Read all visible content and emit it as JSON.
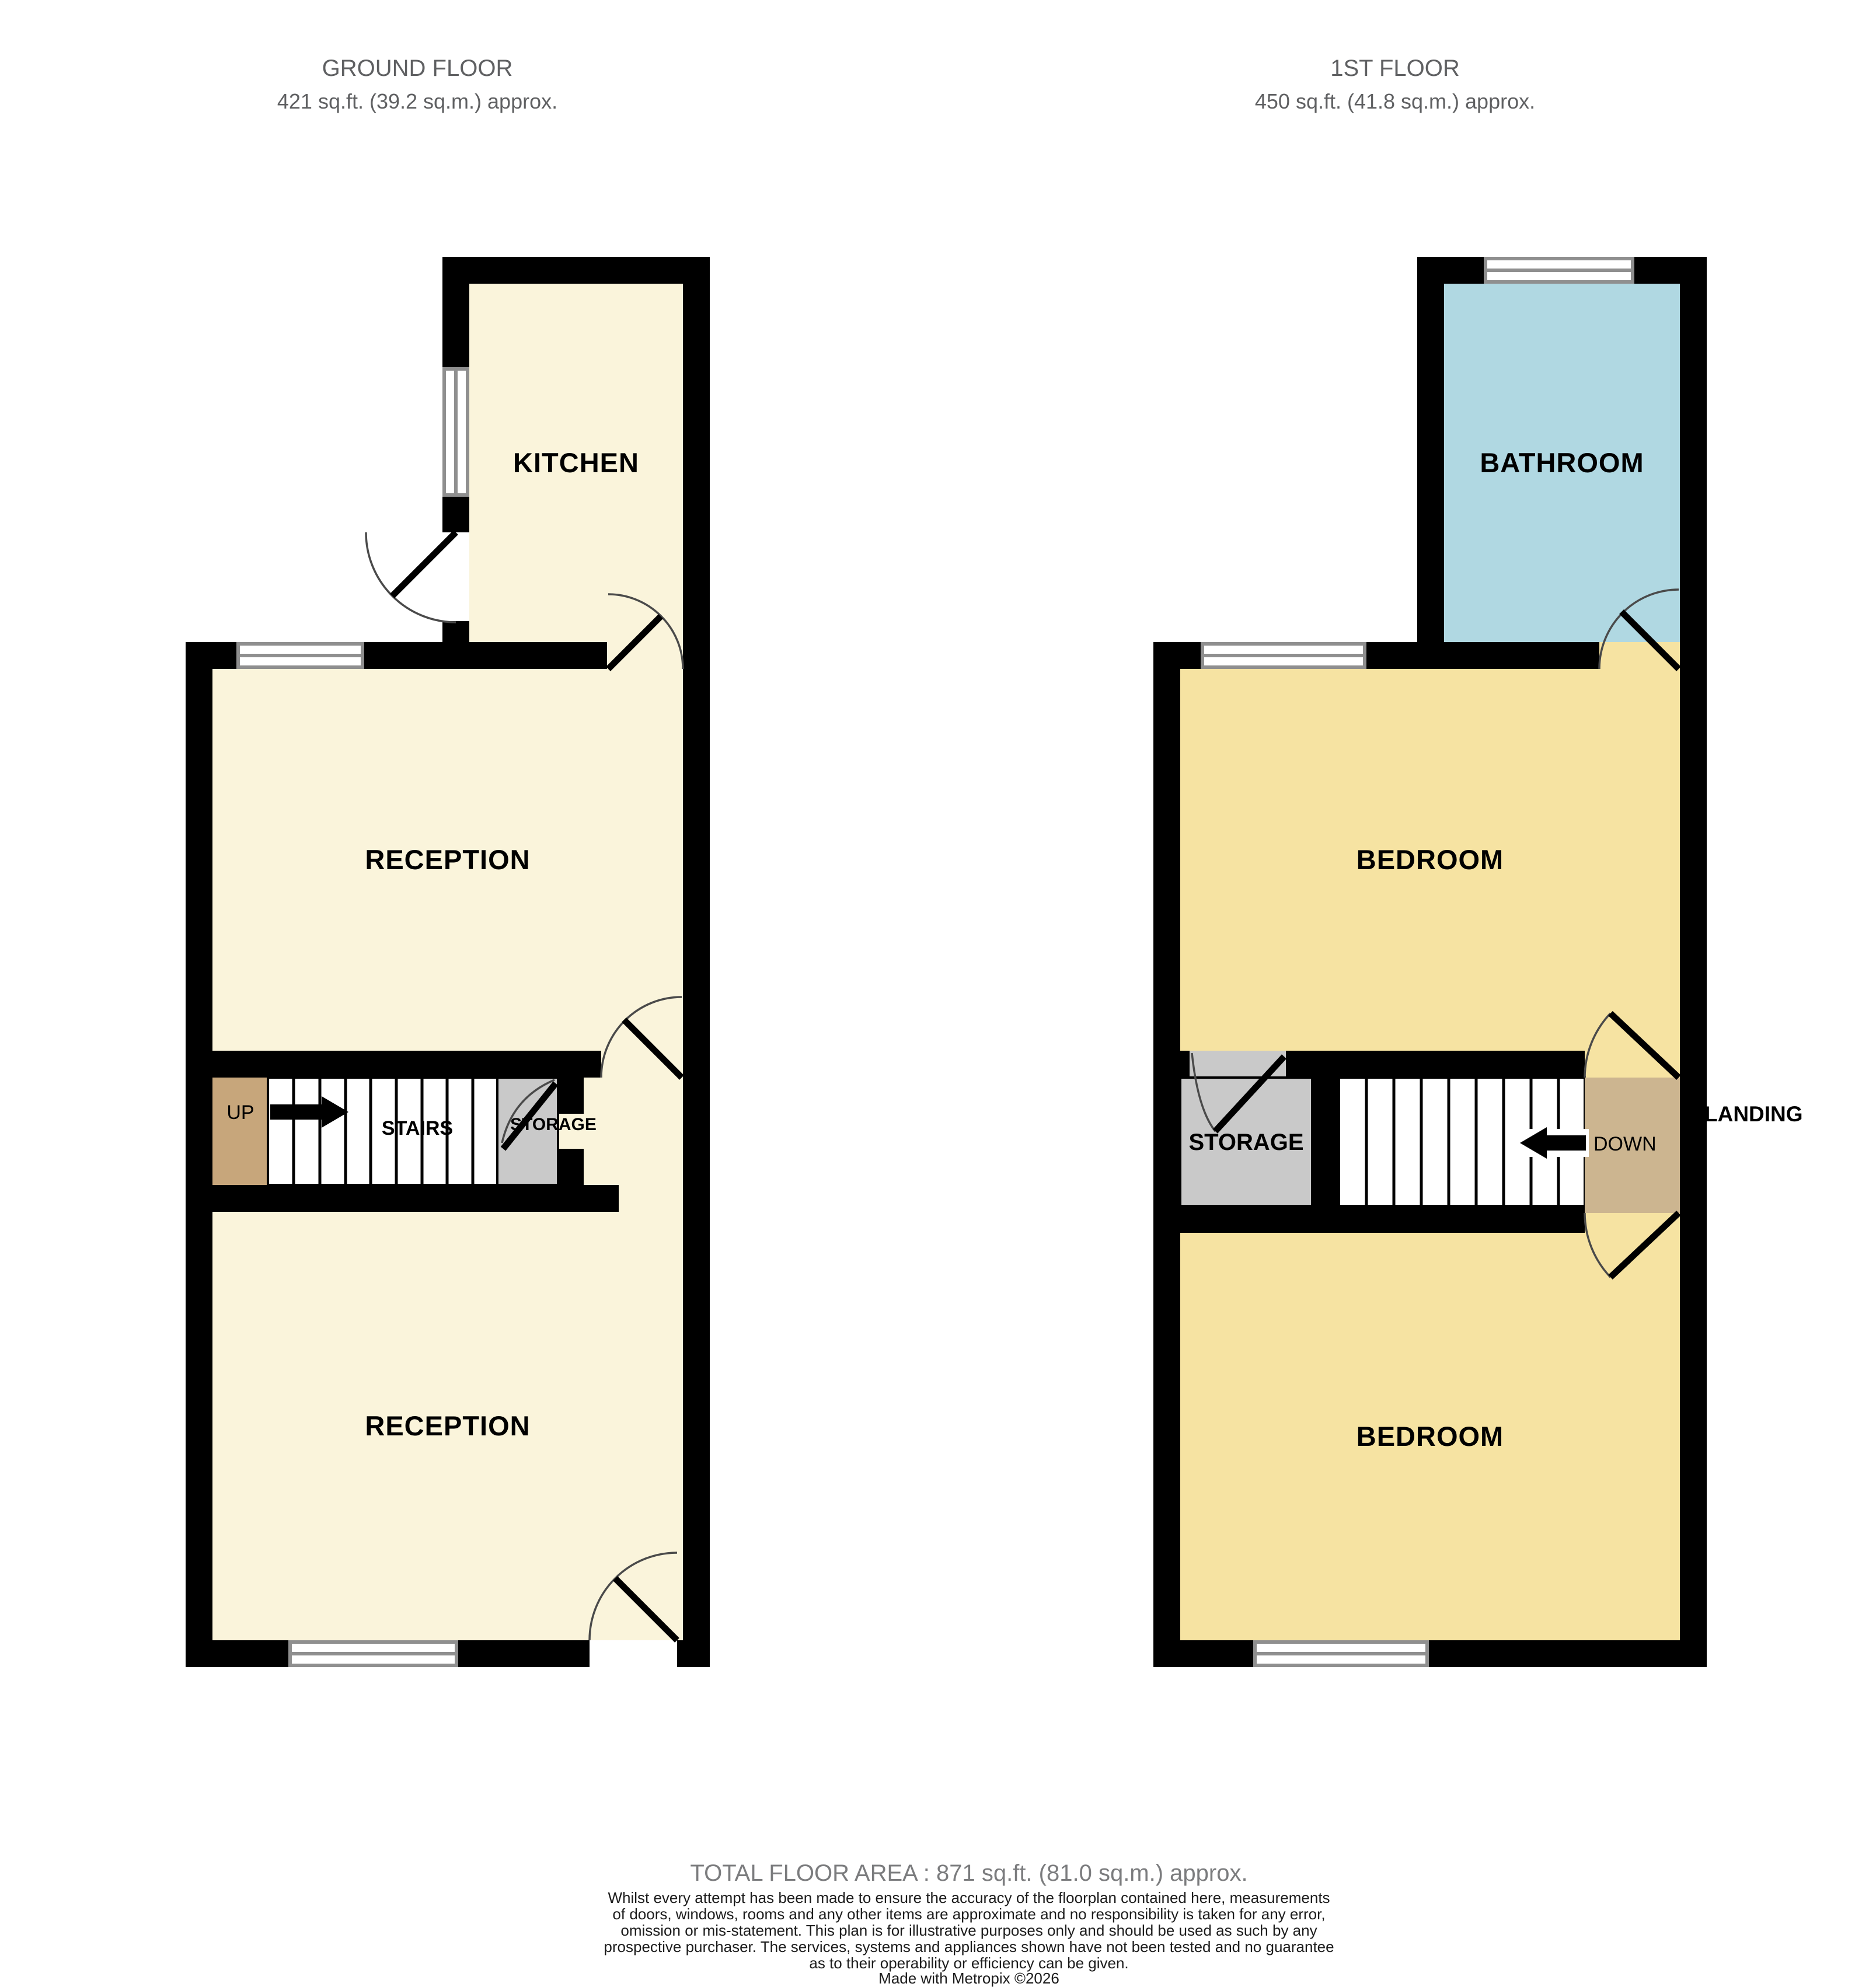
{
  "ground_floor": {
    "title": "GROUND FLOOR",
    "subtitle": "421 sq.ft. (39.2 sq.m.) approx.",
    "labels": {
      "kitchen": "KITCHEN",
      "reception_front": "RECEPTION",
      "reception_back": "RECEPTION",
      "stairs": "STAIRS",
      "storage": "STORAGE",
      "up": "UP"
    }
  },
  "first_floor": {
    "title": "1ST FLOOR",
    "subtitle": "450 sq.ft. (41.8 sq.m.) approx.",
    "labels": {
      "bathroom": "BATHROOM",
      "bedroom_front": "BEDROOM",
      "bedroom_back": "BEDROOM",
      "storage": "STORAGE",
      "landing": "LANDING",
      "down": "DOWN"
    }
  },
  "footer": {
    "total_area": "TOTAL FLOOR AREA : 871 sq.ft. (81.0 sq.m.) approx.",
    "disclaimer_lines": [
      "Whilst every attempt has been made to ensure the accuracy of the floorplan contained here, measurements",
      "of doors, windows, rooms and any other items are approximate and no responsibility is taken for any error,",
      "omission or mis-statement. This plan is for illustrative purposes only and should be used as such by any",
      "prospective purchaser. The services, systems and appliances shown have not been tested and no guarantee",
      "as to their operability or efficiency can be given."
    ],
    "credit": "Made with Metropix ©2026"
  },
  "colors": {
    "floor_cream": "#faf4db",
    "bedroom_yellow": "#f6e3a2",
    "bathroom_blue": "#b0d8e2",
    "storage_gray": "#c9c9c9",
    "stairs_tan": "#c7a67b",
    "landing_tan": "#ccb590",
    "wall_black": "#000000",
    "window_frame": "#8f8f8f",
    "title_gray": "#5f6062",
    "area_gray": "#7b7c7e"
  }
}
